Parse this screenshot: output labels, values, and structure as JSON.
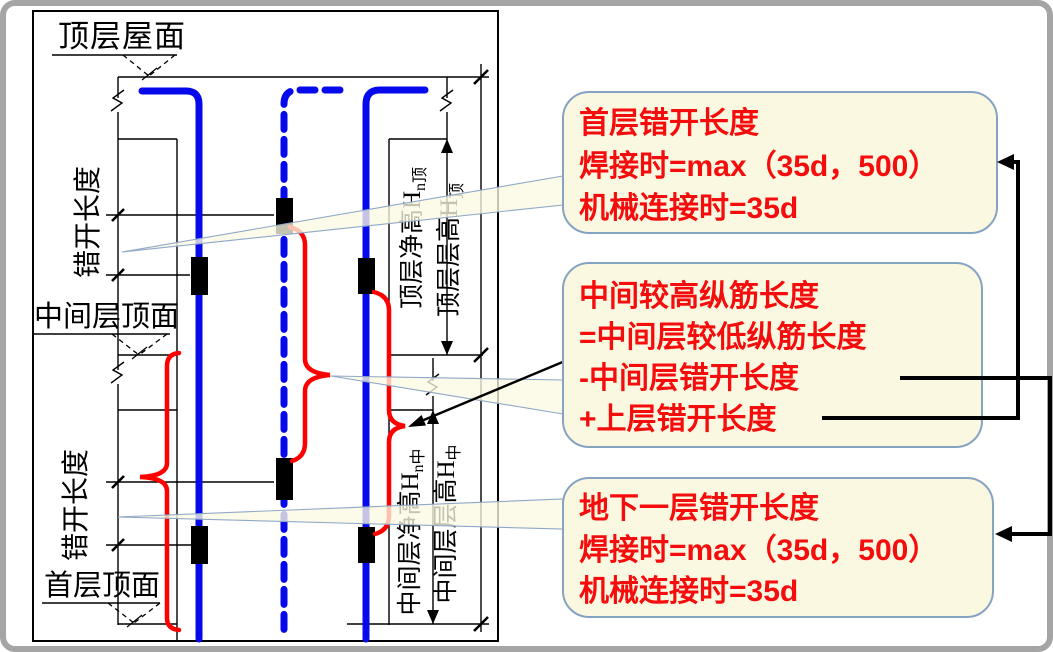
{
  "drawing": {
    "floor_labels": {
      "roof": "顶层屋面",
      "mid": "中间层顶面",
      "first": "首层顶面"
    },
    "stagger_upper": "错开长度",
    "stagger_lower": "错开长度",
    "height_labels": {
      "top_net_main": "顶层净高H",
      "top_net_sub": "n顶",
      "top_story_main": "顶层层高H",
      "top_story_sub": "顶",
      "mid_net_main": "中间层净高H",
      "mid_net_sub": "n中",
      "mid_story_main": "中间层层高H",
      "mid_story_sub": "中"
    }
  },
  "callouts": {
    "first_floor": {
      "line1": "首层错开长度",
      "line2": "焊接时=max（35d，500）",
      "line3": "机械连接时=35d"
    },
    "middle": {
      "line1": "中间较高纵筋长度",
      "line2": "=中间层较低纵筋长度",
      "line3": "-中间层错开长度",
      "line4": "+上层错开长度"
    },
    "basement": {
      "line1": "地下一层错开长度",
      "line2": "焊接时=max（35d，500）",
      "line3": "机械连接时=35d"
    }
  },
  "colors": {
    "callout_fill": "#FBF8E1",
    "callout_border": "#87A3C2",
    "text_red": "#F50D0D",
    "rebar_blue": "#0509EB",
    "brace_red": "#FF0000",
    "line_black": "#000000",
    "frame_gray": "#A5A5A5"
  }
}
